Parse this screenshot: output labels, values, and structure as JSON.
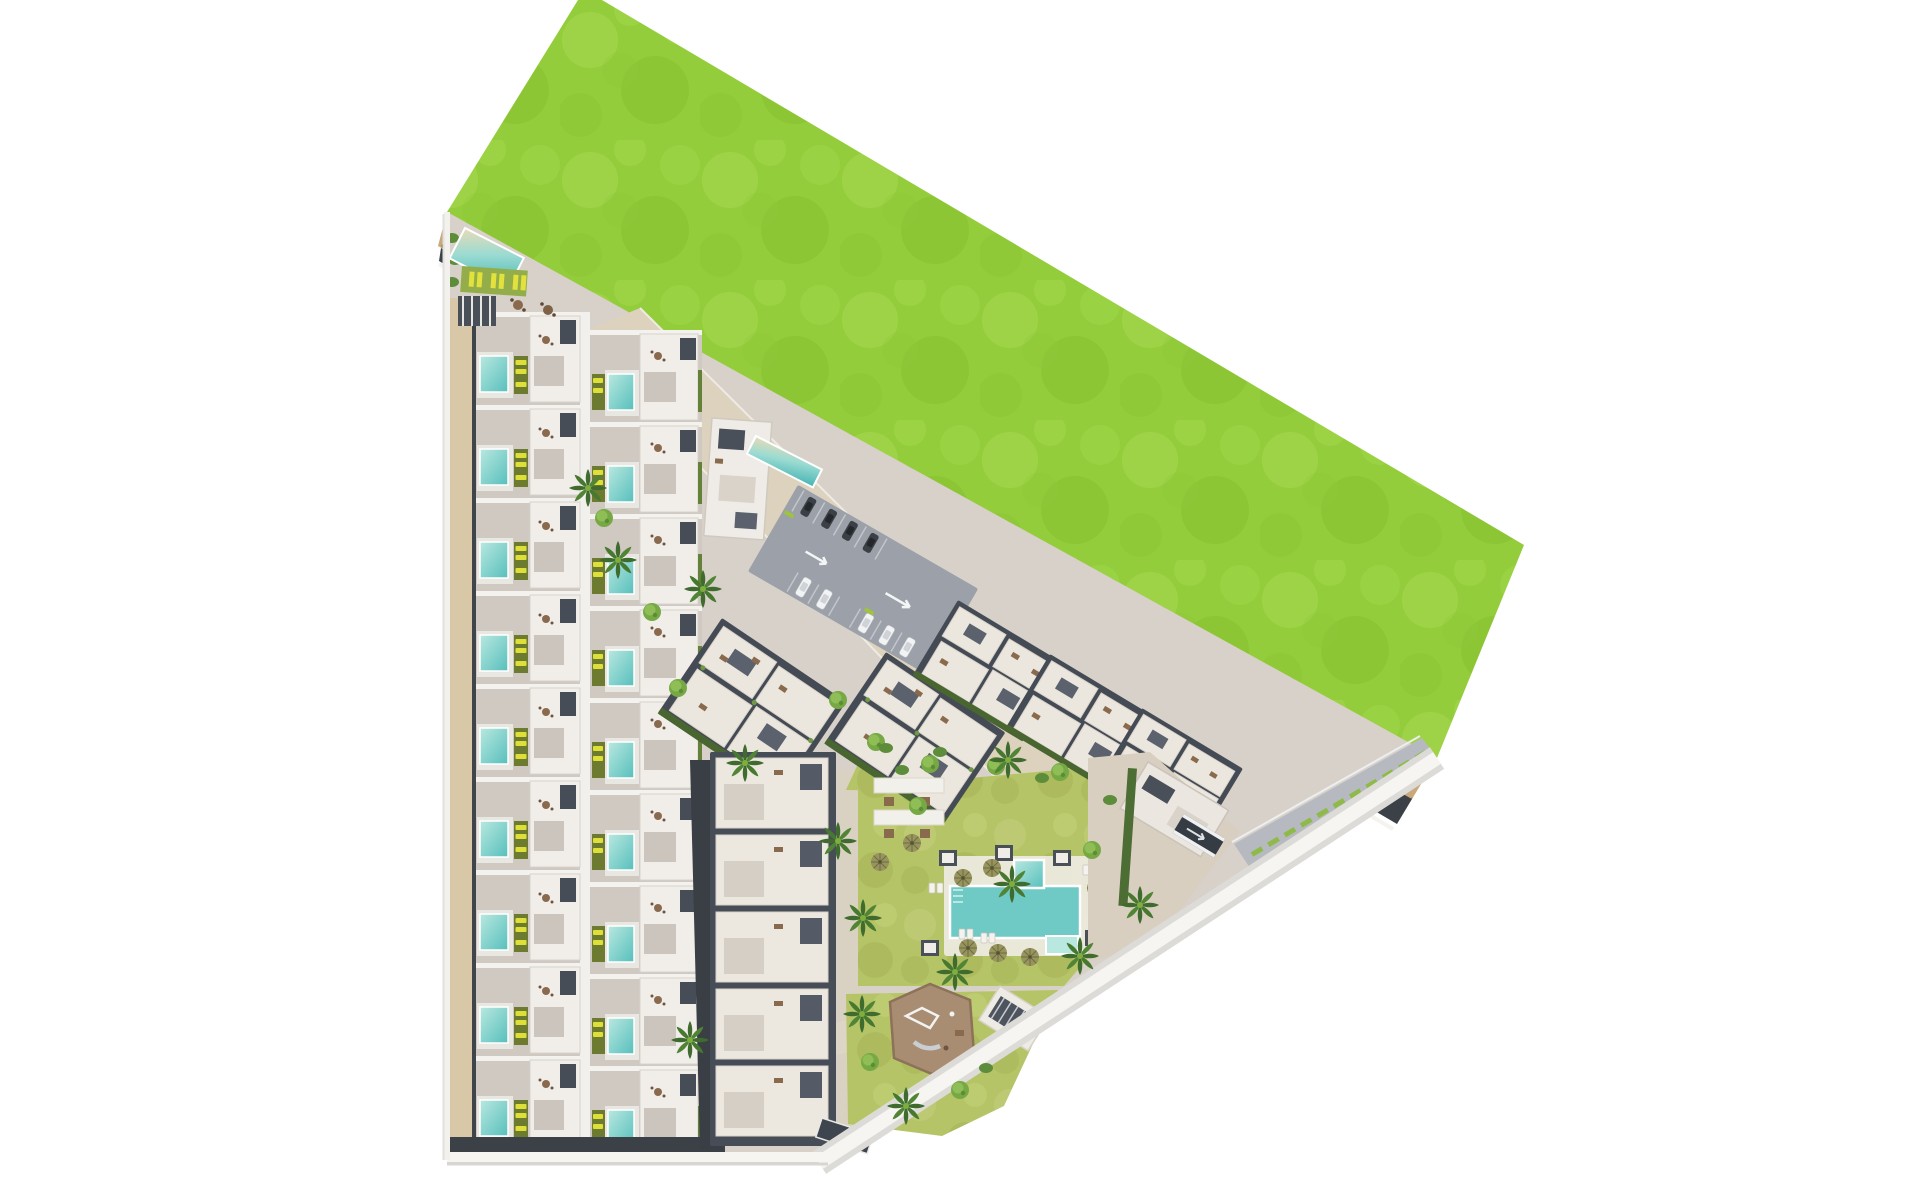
{
  "meta": {
    "type": "aerial-site-plan-rendering",
    "description": "Top-down 3D architectural master plan render of a residential resort development on a triangular plot, bordered by a large undeveloped grass field and a dirt strip along its north-east edge. No text is visible in the image.",
    "visible_text": ""
  },
  "colors": {
    "background": "#ffffff",
    "grass_field": "#94cd3b",
    "grass_light": "#a6d951",
    "grass_dark": "#85c02f",
    "lawn": "#b6c express",
    "lawn_base": "#b6c468",
    "sand_road": "#c9a97c",
    "sand_speckle": "#8d7f4e",
    "paving": "#d7d1c9",
    "promenade": "#dcd2bd",
    "tan_walkway": "#d8c8a8",
    "asphalt": "#9ba0a9",
    "dark_base": "#474d57",
    "wall_dark": "#3c4147",
    "white_roof": "#eee9e1",
    "patio_grey": "#cbc5be",
    "pool_water": "#6fcac5",
    "pool_light": "#b9e8e0",
    "planter_olive": "#6d7b31",
    "lounger_yellow": "#dfdf3a",
    "hedge_green": "#4c6d33",
    "palm_green": "#3f6c2e",
    "tree_green": "#76a844",
    "playground_dirt": "#a88d72",
    "playground_edge": "#8d7158",
    "boundary_white": "#f6f5f2",
    "boundary_grey": "#dcdbd7",
    "median_green": "#8fba49",
    "car_dark": "#3c4046",
    "car_white": "#f2f3f4",
    "furniture_brown": "#8a6a4c"
  },
  "scene": {
    "green_field": {
      "name": "undeveloped grass field",
      "position": "top-right",
      "shape": "large tilted quadrilateral"
    },
    "sand_strip": {
      "name": "dirt / sand strip with scrub vegetation",
      "position": "diagonal band between field and development"
    },
    "perimeter_wall": {
      "name": "dark boundary wall and service road",
      "position": "inside edge of sand strip"
    },
    "townhouse_complex": {
      "name": "townhouse complex",
      "position": "left",
      "rows_left_column": 9,
      "rows_right_column": 9,
      "features": [
        "private plunge pools",
        "olive planters",
        "yellow sun loungers",
        "white roof terraces",
        "tan walkway strip"
      ]
    },
    "amenity_corner": {
      "name": "lap pool and sun deck",
      "position": "top-left",
      "features": [
        "lap pool",
        "sun deck with loungers",
        "pergola",
        "cafe tables"
      ]
    },
    "club_building": {
      "name": "small club building with lap pool",
      "position": "upper middle"
    },
    "parking_lot": {
      "name": "surface parking",
      "cars_dark": 4,
      "cars_light": 5,
      "lane_arrows": 2
    },
    "apartment_blocks": {
      "middle_blocks": 2,
      "right_blocks": 3,
      "bottom_block_units": 5
    },
    "central_garden": {
      "name": "communal garden",
      "main_pool": {
        "shape": "L-shaped with kids lobe",
        "water": "turquoise"
      },
      "pergolas": 2,
      "umbrellas": 9,
      "cabanas": 5,
      "playground": {
        "surface": "brown softfall",
        "equipment": [
          "climbing frame",
          "slide"
        ]
      },
      "palm_trees": 14,
      "round_trees": 12
    },
    "right_plaza": {
      "name": "entrance plaza",
      "features": [
        "gatehouse building",
        "garage ramp",
        "hedge screen"
      ]
    },
    "entrance_road": {
      "name": "entry road with green median",
      "position": "far right corner"
    },
    "boundary": {
      "name": "white kerb boundary",
      "edges": [
        "left vertical",
        "bottom horizontal",
        "long diagonal lower-right"
      ]
    }
  }
}
